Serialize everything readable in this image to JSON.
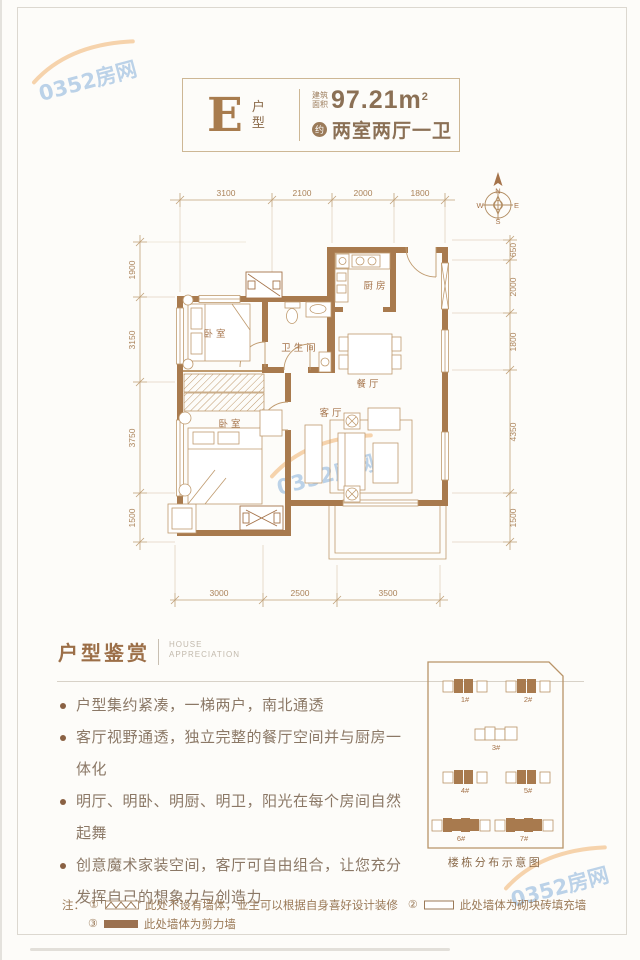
{
  "header": {
    "type_letter": "E",
    "type_label": "户型",
    "area_label_line1": "建筑",
    "area_label_line2": "面积",
    "area_value": "97.21m",
    "area_exponent": "2",
    "approx_badge": "约",
    "layout_text": "两室两厅一卫"
  },
  "floor_plan": {
    "rooms": [
      {
        "name": "卧室"
      },
      {
        "name": "卫生间"
      },
      {
        "name": "厨房"
      },
      {
        "name": "餐厅"
      },
      {
        "name": "客厅"
      },
      {
        "name": "卧室"
      }
    ],
    "dimensions": {
      "top": [
        "3100",
        "2100",
        "2000",
        "1800"
      ],
      "left": [
        "1900",
        "3150",
        "3750",
        "1500"
      ],
      "right": [
        "650",
        "2000",
        "1800",
        "4350",
        "1500"
      ],
      "bottom": [
        "3000",
        "2500",
        "3500"
      ]
    },
    "compass": {
      "n": "N",
      "w": "W",
      "e": "E",
      "s": "S"
    }
  },
  "appreciation": {
    "title_cn": "户型鉴赏",
    "subtitle_en_line1": "HOUSE",
    "subtitle_en_line2": "APPRECIATION",
    "bullets": [
      "户型集约紧凑，一梯两户，南北通透",
      "客厅视野通透，独立完整的餐厅空间并与厨房一体化",
      "明厅、明卧、明厨、明卫，阳光在每个房间自然起舞",
      "创意魔术家装空间，客厅可自由组合，让您充分发挥自己的想象力与创造力"
    ]
  },
  "site_plan": {
    "caption": "楼栋分布示意图",
    "buildings": [
      {
        "label": "1#",
        "highlighted": true
      },
      {
        "label": "2#",
        "highlighted": true
      },
      {
        "label": "3#",
        "highlighted": false
      },
      {
        "label": "4#",
        "highlighted": true
      },
      {
        "label": "5#",
        "highlighted": true
      },
      {
        "label": "6#",
        "highlighted": true
      },
      {
        "label": "7#",
        "highlighted": true
      }
    ]
  },
  "notes": {
    "prefix": "注：",
    "items": [
      {
        "num": "①",
        "symbol": "no-wall-hatch",
        "text": "此处不设有墙体，业主可以根据自身喜好设计装修"
      },
      {
        "num": "②",
        "symbol": "block-infill-outline",
        "text": "此处墙体为砌块砖填充墙"
      },
      {
        "num": "③",
        "symbol": "shear-wall-solid",
        "text": "此处墙体为剪力墙"
      }
    ]
  },
  "watermark": {
    "text": "0352房网"
  },
  "colors": {
    "wall_brown": "#a87a4e",
    "plan_line": "#bf9a6e",
    "dim_text": "#ab835a",
    "heading_brown": "#9c6f48",
    "body_text": "#8b7866",
    "watermark_blue": "#7ba7d8",
    "watermark_orange": "#f0a95f"
  }
}
